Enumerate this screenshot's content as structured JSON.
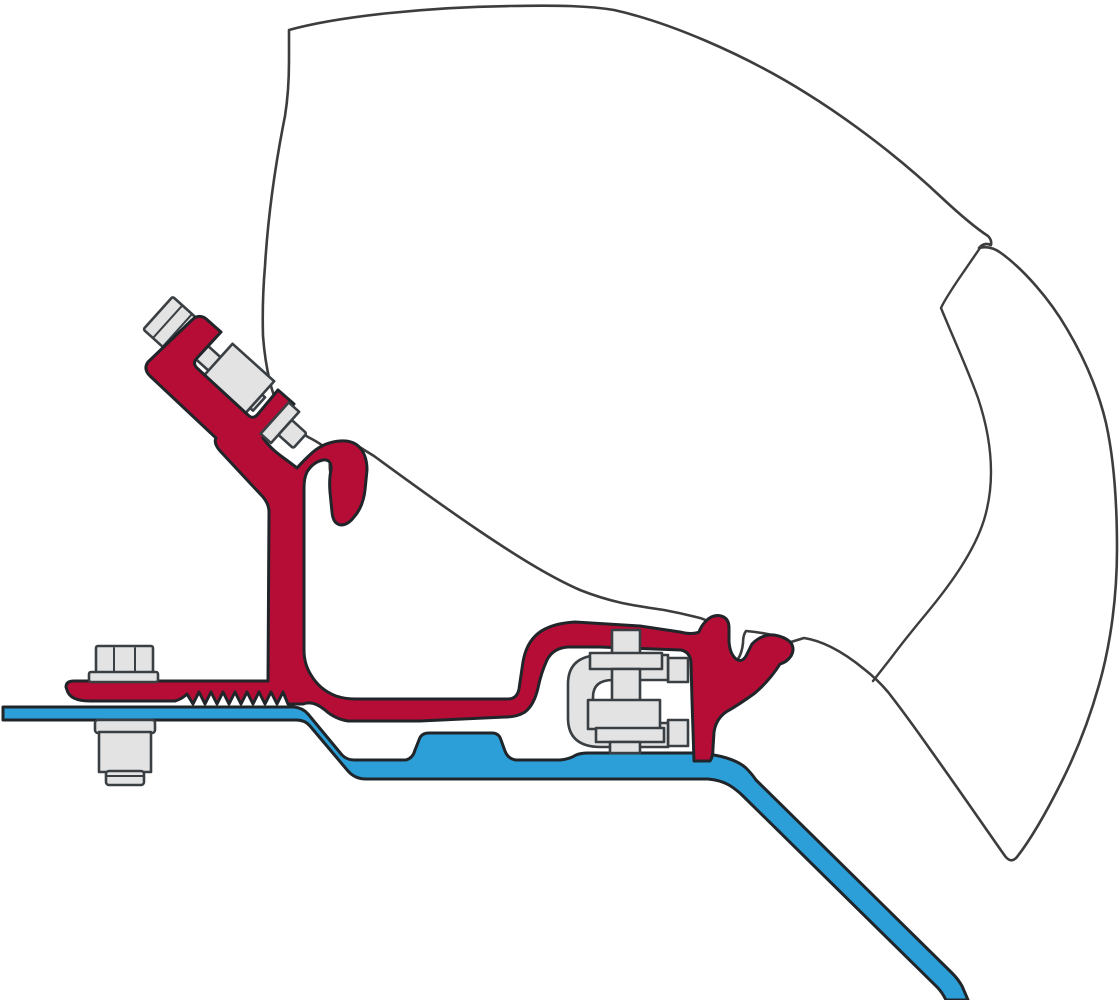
{
  "canvas": {
    "width": 1120,
    "height": 1000
  },
  "diagram": {
    "kind": "technical-cutaway-illustration",
    "subject": "awning-rail-adapter-bracket-cross-section",
    "components": [
      {
        "id": "awning-case-shell",
        "color_ref": "case_white"
      },
      {
        "id": "case-lid-seam",
        "color_ref": "outline_dark"
      },
      {
        "id": "adapter-bracket",
        "color_ref": "bracket_red"
      },
      {
        "id": "roof-rail-profile",
        "color_ref": "rail_blue"
      },
      {
        "id": "gutter-clamp-bolt",
        "color_ref": "fastener_gray"
      },
      {
        "id": "base-fixing-bolt",
        "color_ref": "fastener_gray"
      },
      {
        "id": "center-clamp-bracket",
        "color_ref": "fastener_gray"
      }
    ]
  },
  "colors": {
    "background": "#ffffff",
    "case_white": "#ffffff",
    "bracket_red": "#b60d36",
    "rail_blue": "#2d9fd8",
    "fastener_gray": "#e3e3e3",
    "outline_dark": "#3d3d3d"
  }
}
